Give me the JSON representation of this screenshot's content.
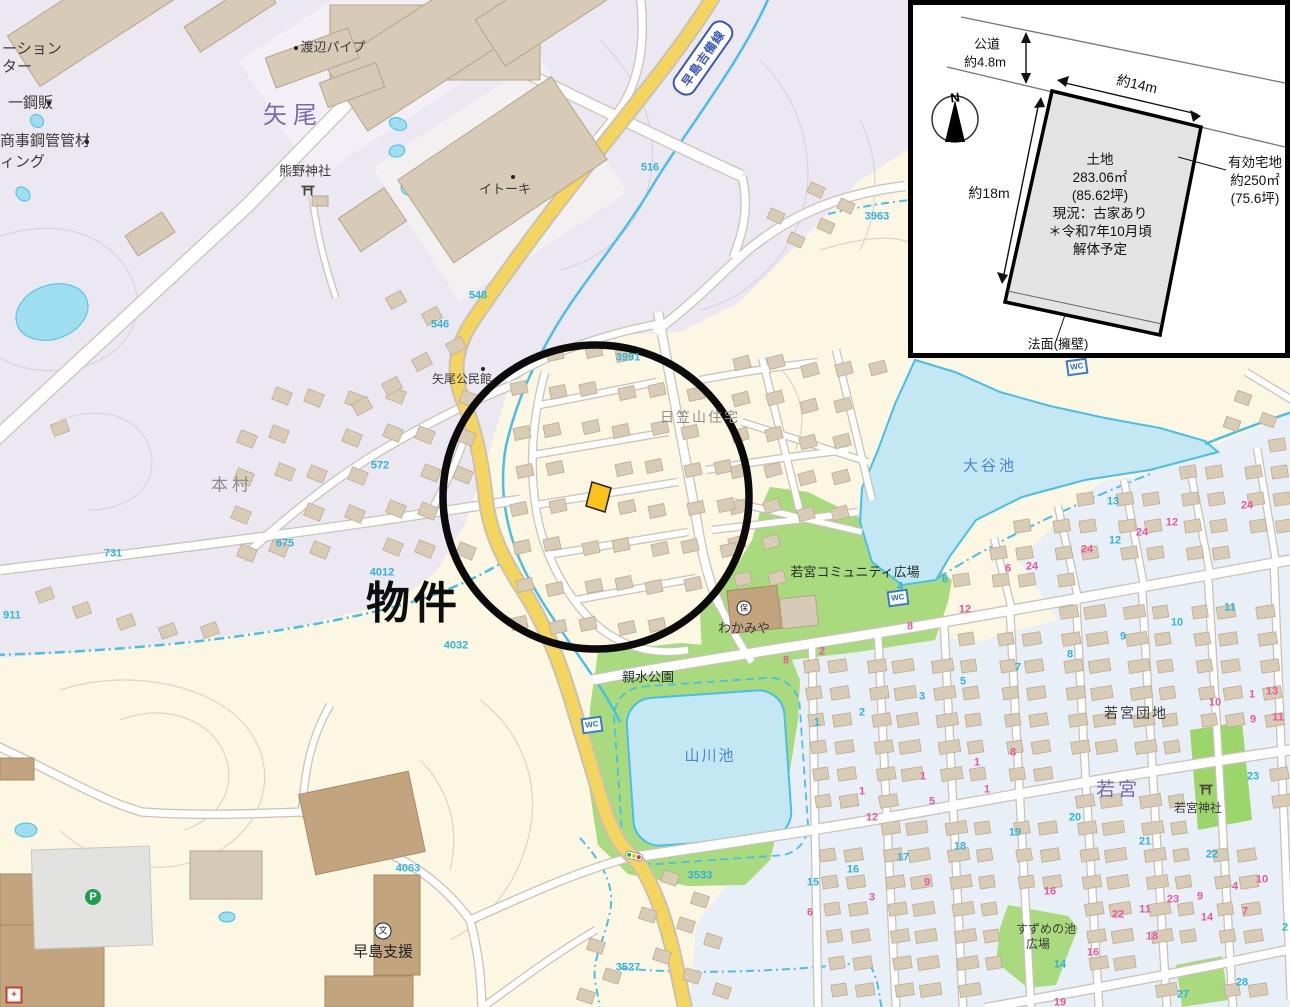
{
  "map": {
    "property_label": "物件",
    "route_badge": "早島吉備線",
    "areas": {
      "yao": "矢尾",
      "honmura": "本村",
      "wakamiya": "若宮",
      "hikasayama": "日笠山住宅",
      "wakamiya_danchi": "若宮団地"
    },
    "pois": {
      "station_line1": "ーション",
      "station_line2": "ター",
      "kohan": "一鋼販",
      "shoji": "商事鋼管管材",
      "ing": "ィング",
      "watanabe_pipe": "渡辺パイプ",
      "kumano_jinja": "熊野神社",
      "itoki": "イトーキ",
      "yao_kominkan": "矢尾公民館",
      "wakamiya_hoikuen": "わかみや",
      "wakamiya_plaza": "若宮コミュニティ広場",
      "shinsui_park": "親水公園",
      "wakamiya_jinja": "若宮神社",
      "suzume_line1": "すずめの池",
      "suzume_line2": "広場",
      "hayashima_shien": "早島支援"
    },
    "water": {
      "otani_ike": "大谷池",
      "yamakawa_ike": "山川池"
    },
    "icons": {
      "wc": "WC",
      "parking": "P",
      "school": "文",
      "nursery": "保",
      "north": "N"
    },
    "numbers": [
      {
        "t": "548",
        "x": 478,
        "y": 296,
        "c": "cyan"
      },
      {
        "t": "546",
        "x": 440,
        "y": 325,
        "c": "cyan"
      },
      {
        "t": "516",
        "x": 650,
        "y": 168,
        "c": "cyan"
      },
      {
        "t": "572",
        "x": 380,
        "y": 466,
        "c": "cyan"
      },
      {
        "t": "675",
        "x": 285,
        "y": 544,
        "c": "cyan"
      },
      {
        "t": "731",
        "x": 113,
        "y": 554,
        "c": "cyan"
      },
      {
        "t": "911",
        "x": 12,
        "y": 616,
        "c": "cyan"
      },
      {
        "t": "4012",
        "x": 382,
        "y": 573,
        "c": "cyan"
      },
      {
        "t": "4032",
        "x": 456,
        "y": 646,
        "c": "cyan"
      },
      {
        "t": "4063",
        "x": 408,
        "y": 869,
        "c": "cyan"
      },
      {
        "t": "3963",
        "x": 877,
        "y": 217,
        "c": "cyan"
      },
      {
        "t": "3991",
        "x": 628,
        "y": 358,
        "c": "cyan"
      },
      {
        "t": "3533",
        "x": 700,
        "y": 876,
        "c": "cyan"
      },
      {
        "t": "3527",
        "x": 628,
        "y": 968,
        "c": "cyan"
      },
      {
        "t": "13",
        "x": 1113,
        "y": 502,
        "c": "cyan"
      },
      {
        "t": "24",
        "x": 1247,
        "y": 506,
        "c": "pink"
      },
      {
        "t": "12",
        "x": 1172,
        "y": 523,
        "c": "pink"
      },
      {
        "t": "24",
        "x": 1142,
        "y": 533,
        "c": "pink"
      },
      {
        "t": "12",
        "x": 1115,
        "y": 541,
        "c": "cyan"
      },
      {
        "t": "24",
        "x": 1087,
        "y": 550,
        "c": "pink"
      },
      {
        "t": "24",
        "x": 1032,
        "y": 567,
        "c": "pink"
      },
      {
        "t": "6",
        "x": 1008,
        "y": 569,
        "c": "pink"
      },
      {
        "t": "6",
        "x": 945,
        "y": 580,
        "c": "cyan"
      },
      {
        "t": "4",
        "x": 900,
        "y": 587,
        "c": "cyan"
      },
      {
        "t": "11",
        "x": 1230,
        "y": 608,
        "c": "cyan"
      },
      {
        "t": "10",
        "x": 1177,
        "y": 623,
        "c": "cyan"
      },
      {
        "t": "9",
        "x": 1123,
        "y": 637,
        "c": "cyan"
      },
      {
        "t": "8",
        "x": 1070,
        "y": 655,
        "c": "cyan"
      },
      {
        "t": "7",
        "x": 1018,
        "y": 668,
        "c": "cyan"
      },
      {
        "t": "5",
        "x": 963,
        "y": 682,
        "c": "cyan"
      },
      {
        "t": "3",
        "x": 922,
        "y": 697,
        "c": "cyan"
      },
      {
        "t": "2",
        "x": 862,
        "y": 713,
        "c": "cyan"
      },
      {
        "t": "1",
        "x": 817,
        "y": 723,
        "c": "cyan"
      },
      {
        "t": "12",
        "x": 965,
        "y": 610,
        "c": "pink"
      },
      {
        "t": "8",
        "x": 910,
        "y": 627,
        "c": "pink"
      },
      {
        "t": "2",
        "x": 822,
        "y": 652,
        "c": "pink"
      },
      {
        "t": "8",
        "x": 786,
        "y": 661,
        "c": "pink"
      },
      {
        "t": "1",
        "x": 977,
        "y": 763,
        "c": "pink"
      },
      {
        "t": "1",
        "x": 923,
        "y": 777,
        "c": "pink"
      },
      {
        "t": "1",
        "x": 862,
        "y": 792,
        "c": "pink"
      },
      {
        "t": "1",
        "x": 987,
        "y": 790,
        "c": "pink"
      },
      {
        "t": "5",
        "x": 932,
        "y": 802,
        "c": "pink"
      },
      {
        "t": "12",
        "x": 872,
        "y": 818,
        "c": "pink"
      },
      {
        "t": "18",
        "x": 960,
        "y": 847,
        "c": "cyan"
      },
      {
        "t": "17",
        "x": 903,
        "y": 858,
        "c": "cyan"
      },
      {
        "t": "16",
        "x": 853,
        "y": 870,
        "c": "cyan"
      },
      {
        "t": "15",
        "x": 813,
        "y": 883,
        "c": "cyan"
      },
      {
        "t": "3",
        "x": 872,
        "y": 898,
        "c": "pink"
      },
      {
        "t": "6",
        "x": 810,
        "y": 913,
        "c": "pink"
      },
      {
        "t": "9",
        "x": 927,
        "y": 883,
        "c": "pink"
      },
      {
        "t": "10",
        "x": 1215,
        "y": 703,
        "c": "pink"
      },
      {
        "t": "1",
        "x": 1252,
        "y": 695,
        "c": "pink"
      },
      {
        "t": "13",
        "x": 1272,
        "y": 692,
        "c": "pink"
      },
      {
        "t": "9",
        "x": 1253,
        "y": 720,
        "c": "pink"
      },
      {
        "t": "11",
        "x": 1278,
        "y": 718,
        "c": "pink"
      },
      {
        "t": "8",
        "x": 1013,
        "y": 753,
        "c": "pink"
      },
      {
        "t": "23",
        "x": 1253,
        "y": 777,
        "c": "cyan"
      },
      {
        "t": "20",
        "x": 1075,
        "y": 818,
        "c": "cyan"
      },
      {
        "t": "19",
        "x": 1015,
        "y": 833,
        "c": "cyan"
      },
      {
        "t": "21",
        "x": 1145,
        "y": 842,
        "c": "cyan"
      },
      {
        "t": "22",
        "x": 1212,
        "y": 855,
        "c": "cyan"
      },
      {
        "t": "16",
        "x": 1050,
        "y": 892,
        "c": "pink"
      },
      {
        "t": "10",
        "x": 1262,
        "y": 880,
        "c": "pink"
      },
      {
        "t": "4",
        "x": 1235,
        "y": 887,
        "c": "pink"
      },
      {
        "t": "9",
        "x": 1200,
        "y": 897,
        "c": "pink"
      },
      {
        "t": "23",
        "x": 1173,
        "y": 900,
        "c": "pink"
      },
      {
        "t": "11",
        "x": 1145,
        "y": 910,
        "c": "pink"
      },
      {
        "t": "22",
        "x": 1118,
        "y": 915,
        "c": "pink"
      },
      {
        "t": "7",
        "x": 1245,
        "y": 912,
        "c": "pink"
      },
      {
        "t": "14",
        "x": 1207,
        "y": 918,
        "c": "pink"
      },
      {
        "t": "18",
        "x": 1152,
        "y": 937,
        "c": "pink"
      },
      {
        "t": "16",
        "x": 1093,
        "y": 953,
        "c": "pink"
      },
      {
        "t": "14",
        "x": 1060,
        "y": 965,
        "c": "cyan"
      },
      {
        "t": "19",
        "x": 1060,
        "y": 1003,
        "c": "pink"
      },
      {
        "t": "2",
        "x": 1285,
        "y": 928,
        "c": "cyan"
      },
      {
        "t": "28",
        "x": 1242,
        "y": 983,
        "c": "cyan"
      },
      {
        "t": "27",
        "x": 1183,
        "y": 995,
        "c": "cyan"
      }
    ]
  },
  "inset": {
    "road_name": "公道",
    "road_width": "約4.8m",
    "top_width": "約14m",
    "left_height": "約18m",
    "land_lines": [
      "土地",
      "283.06㎡",
      "(85.62坪)",
      "現況：古家あり",
      "＊令和7年10月頃",
      "解体予定"
    ],
    "effective_lines": [
      "有効宅地",
      "約250㎡",
      "(75.6坪)"
    ],
    "slope": "法面(擁壁)"
  },
  "colors": {
    "cream": "#FBF7E3",
    "lavender": "#ECE8F2",
    "pale_blue": "#E9EFF7",
    "water": "#C3E7F3",
    "water_edge": "#49BFE3",
    "green": "#A9DA7D",
    "road_yellow": "#F4D55F",
    "house": "#D9CCB7",
    "house_edge": "#BCAB90",
    "brown": "#C2A57F",
    "cyan_text": "#2FB4DC",
    "pink_text": "#E8579B",
    "purple_text": "#7B6BA8",
    "blue_text": "#4A86C8",
    "badge_blue": "#3A57B5",
    "circle": "#0B0B0B",
    "plot": "#FBC21B"
  }
}
